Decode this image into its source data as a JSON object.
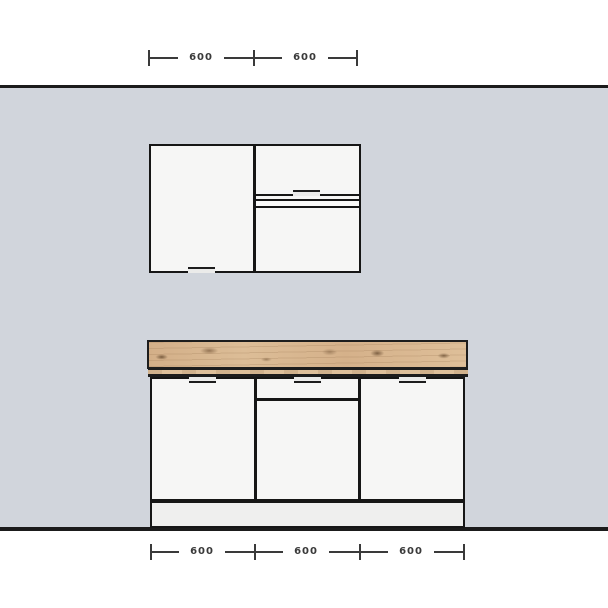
{
  "drawing": {
    "title": "kitchen-elevation",
    "top_dimensions": {
      "labels": [
        "600",
        "600"
      ]
    },
    "bottom_dimensions": {
      "labels": [
        "600",
        "600",
        "600"
      ]
    },
    "components": {
      "wall": "back wall",
      "wall_cabinet_left": "wall cabinet single door",
      "wall_cabinet_right_flap": "wall cabinet flap front",
      "wall_cabinet_right_door": "wall cabinet lower door",
      "worktop": "wood worktop",
      "base_left_door": "base cabinet door",
      "base_drawer": "base cabinet drawer front",
      "base_middle_door": "base cabinet middle door",
      "base_right_door": "base cabinet door",
      "plinth": "toe kick plinth"
    },
    "colors": {
      "background": "#ffffff",
      "wall": "#d1d5dc",
      "outline": "#161616",
      "cabinet_front": "#f6f6f5",
      "plinth": "#efefee",
      "worktop_wood": "#d9b68e",
      "worktop_knot": "#6f5236",
      "dimension": "#3a3a3a"
    }
  }
}
